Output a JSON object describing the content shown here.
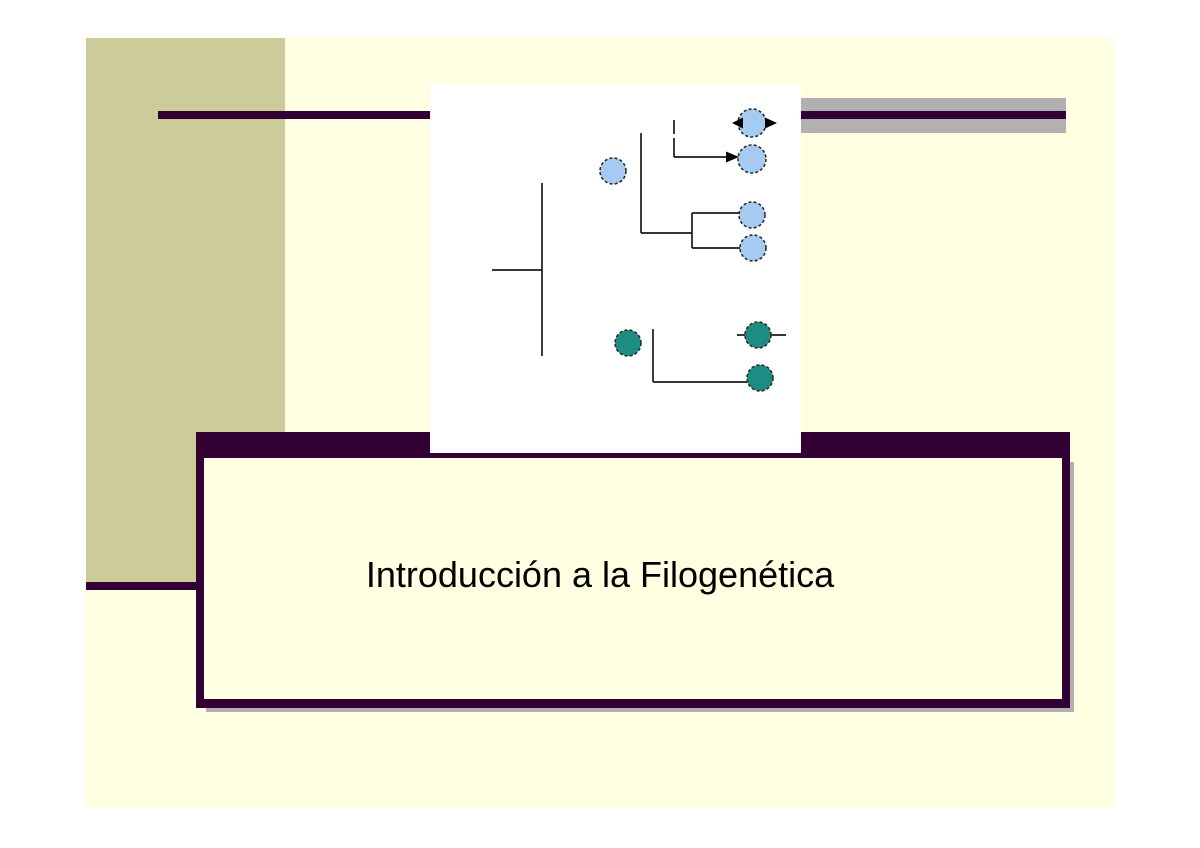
{
  "slide": {
    "title": "Introducción a la Filogenética"
  },
  "colors": {
    "page_background": "#FFFFFF",
    "slide_background": "#FFFFE1",
    "left_band": "#CCCC99",
    "accent_purple": "#330033",
    "gray_bar": "#B1B1B1",
    "node_blue": "#A6CBF2",
    "node_teal": "#1E8C82",
    "tree_lines": "#1A1A1A",
    "title_text": "#000000"
  },
  "diagram": {
    "type": "phylogenetic-tree",
    "blue_nodes": 5,
    "teal_nodes": 3,
    "arrowheads": 3
  }
}
